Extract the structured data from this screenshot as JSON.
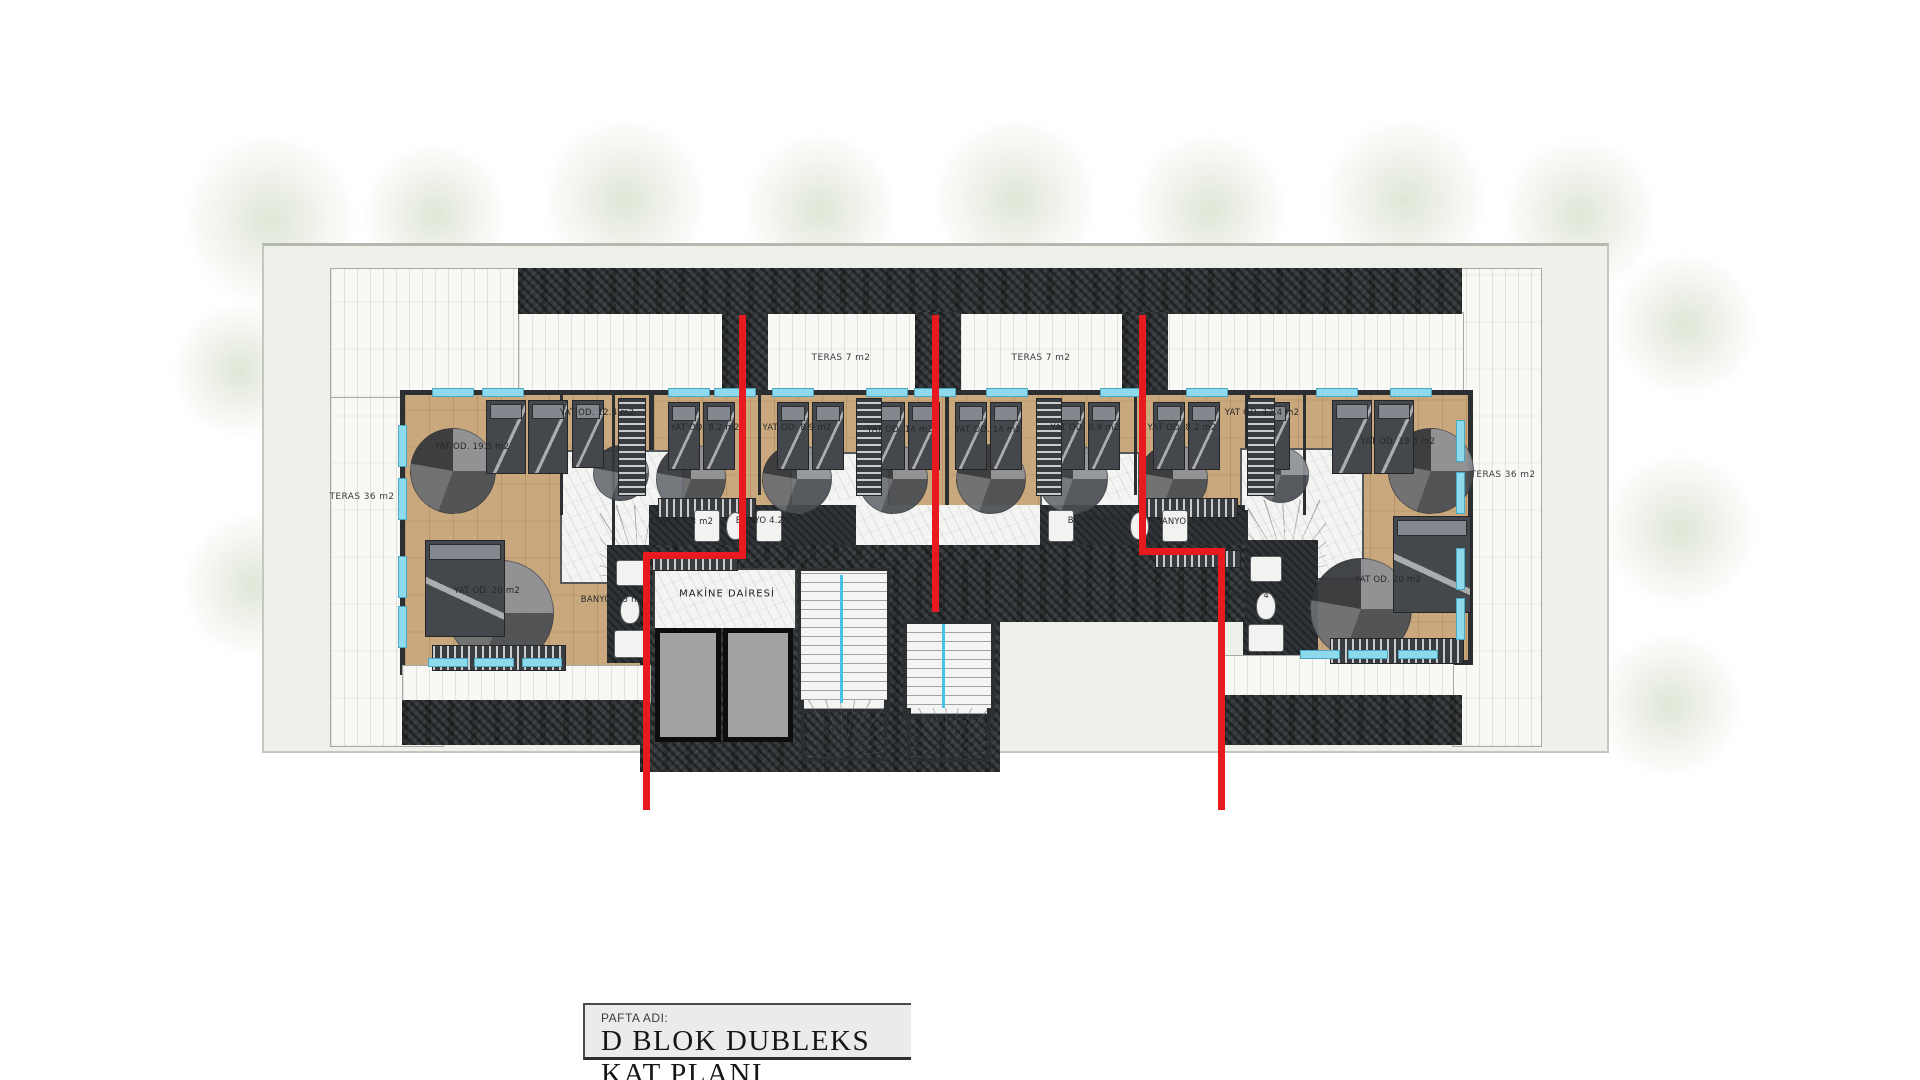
{
  "title_block": {
    "label": "PAFTA ADI:",
    "title": "D BLOK DUBLEKS KAT PLANI"
  },
  "labels": [
    {
      "text": "TERAS 36 m2",
      "x": 362,
      "y": 497,
      "cls": "teras"
    },
    {
      "text": "TERAS 36 m2",
      "x": 1503,
      "y": 475,
      "cls": "teras"
    },
    {
      "text": "TERAS 7 m2",
      "x": 841,
      "y": 358,
      "cls": "teras"
    },
    {
      "text": "TERAS 7 m2",
      "x": 1041,
      "y": 358,
      "cls": "teras"
    },
    {
      "text": "YAT OD. 19.5 m2",
      "x": 472,
      "y": 447,
      "cls": ""
    },
    {
      "text": "YAT OD. 12.4 m2",
      "x": 597,
      "y": 413,
      "cls": ""
    },
    {
      "text": "YAT OD. 8.2 m2",
      "x": 705,
      "y": 428,
      "cls": ""
    },
    {
      "text": "YAT OD. 8.9 m2",
      "x": 797,
      "y": 428,
      "cls": ""
    },
    {
      "text": "YAT OD. 14 m2",
      "x": 900,
      "y": 430,
      "cls": ""
    },
    {
      "text": "YAT OD. 14 m2",
      "x": 988,
      "y": 430,
      "cls": ""
    },
    {
      "text": "YAT OD. 8.9 m2",
      "x": 1085,
      "y": 428,
      "cls": ""
    },
    {
      "text": "YAT OD. 8.2 m2",
      "x": 1182,
      "y": 428,
      "cls": ""
    },
    {
      "text": "YAT OD. 12.4 m2",
      "x": 1262,
      "y": 413,
      "cls": ""
    },
    {
      "text": "YAT OD. 19.5 m2",
      "x": 1398,
      "y": 442,
      "cls": ""
    },
    {
      "text": "YAT OD. 20 m2",
      "x": 487,
      "y": 591,
      "cls": ""
    },
    {
      "text": "YAT OD. 20 m2",
      "x": 1388,
      "y": 580,
      "cls": ""
    },
    {
      "text": "BANYO 4.3 m2",
      "x": 681,
      "y": 522,
      "cls": ""
    },
    {
      "text": "BANYO 4.2 m2",
      "x": 768,
      "y": 521,
      "cls": ""
    },
    {
      "text": "BANYO 4.2 m2",
      "x": 1100,
      "y": 521,
      "cls": ""
    },
    {
      "text": "BANYO 4.3 m2",
      "x": 1188,
      "y": 522,
      "cls": ""
    },
    {
      "text": "BANYO 3.5 m2",
      "x": 613,
      "y": 600,
      "cls": ""
    },
    {
      "text": "BANYO 4 m2",
      "x": 1258,
      "y": 596,
      "cls": ""
    },
    {
      "text": "MAKİNE DAİRESİ",
      "x": 727,
      "y": 594,
      "cls": "big"
    }
  ],
  "plan": {
    "beds_vertical": [
      {
        "x": 486,
        "y": 400,
        "w": 38,
        "h": 72
      },
      {
        "x": 528,
        "y": 400,
        "w": 38,
        "h": 72
      },
      {
        "x": 572,
        "y": 400,
        "w": 30,
        "h": 66
      },
      {
        "x": 668,
        "y": 402,
        "w": 30,
        "h": 66
      },
      {
        "x": 703,
        "y": 402,
        "w": 30,
        "h": 66
      },
      {
        "x": 777,
        "y": 402,
        "w": 30,
        "h": 66
      },
      {
        "x": 812,
        "y": 402,
        "w": 30,
        "h": 66
      },
      {
        "x": 873,
        "y": 402,
        "w": 30,
        "h": 66
      },
      {
        "x": 908,
        "y": 402,
        "w": 30,
        "h": 66
      },
      {
        "x": 955,
        "y": 402,
        "w": 30,
        "h": 66
      },
      {
        "x": 990,
        "y": 402,
        "w": 30,
        "h": 66
      },
      {
        "x": 1053,
        "y": 402,
        "w": 30,
        "h": 66
      },
      {
        "x": 1088,
        "y": 402,
        "w": 30,
        "h": 66
      },
      {
        "x": 1153,
        "y": 402,
        "w": 30,
        "h": 66
      },
      {
        "x": 1188,
        "y": 402,
        "w": 30,
        "h": 66
      },
      {
        "x": 1258,
        "y": 402,
        "w": 30,
        "h": 66
      },
      {
        "x": 1332,
        "y": 400,
        "w": 38,
        "h": 72
      },
      {
        "x": 1374,
        "y": 400,
        "w": 38,
        "h": 72
      },
      {
        "x": 425,
        "y": 540,
        "w": 78,
        "h": 95
      },
      {
        "x": 1393,
        "y": 516,
        "w": 76,
        "h": 95
      }
    ],
    "rugs": [
      {
        "cx": 452,
        "cy": 470,
        "r": 42
      },
      {
        "cx": 620,
        "cy": 472,
        "r": 27
      },
      {
        "cx": 690,
        "cy": 478,
        "r": 34
      },
      {
        "cx": 796,
        "cy": 478,
        "r": 34
      },
      {
        "cx": 892,
        "cy": 478,
        "r": 34
      },
      {
        "cx": 990,
        "cy": 478,
        "r": 34
      },
      {
        "cx": 1072,
        "cy": 478,
        "r": 34
      },
      {
        "cx": 1172,
        "cy": 478,
        "r": 34
      },
      {
        "cx": 1280,
        "cy": 474,
        "r": 27
      },
      {
        "cx": 1430,
        "cy": 470,
        "r": 42
      },
      {
        "cx": 500,
        "cy": 612,
        "r": 52
      },
      {
        "cx": 1360,
        "cy": 608,
        "r": 50
      }
    ],
    "wardrobes_h": [
      {
        "x": 432,
        "y": 645,
        "w": 132,
        "h": 24
      },
      {
        "x": 1330,
        "y": 638,
        "w": 132,
        "h": 24
      },
      {
        "x": 658,
        "y": 498,
        "w": 96,
        "h": 18
      },
      {
        "x": 1140,
        "y": 498,
        "w": 96,
        "h": 18
      },
      {
        "x": 652,
        "y": 553,
        "w": 84,
        "h": 16
      },
      {
        "x": 1155,
        "y": 550,
        "w": 84,
        "h": 16
      }
    ],
    "wardrobes_v": [
      {
        "x": 618,
        "y": 398,
        "w": 26,
        "h": 96
      },
      {
        "x": 1247,
        "y": 398,
        "w": 26,
        "h": 96
      },
      {
        "x": 856,
        "y": 398,
        "w": 24,
        "h": 96
      },
      {
        "x": 1036,
        "y": 398,
        "w": 24,
        "h": 96
      }
    ],
    "windows_top": [
      {
        "x": 432,
        "w": 40
      },
      {
        "x": 482,
        "w": 40
      },
      {
        "x": 668,
        "w": 40
      },
      {
        "x": 714,
        "w": 40
      },
      {
        "x": 772,
        "w": 40
      },
      {
        "x": 866,
        "w": 40
      },
      {
        "x": 914,
        "w": 40
      },
      {
        "x": 986,
        "w": 40
      },
      {
        "x": 1100,
        "w": 40
      },
      {
        "x": 1186,
        "w": 40
      },
      {
        "x": 1316,
        "w": 40
      },
      {
        "x": 1390,
        "w": 40
      }
    ],
    "windows_left": [
      {
        "y": 425,
        "h": 40
      },
      {
        "y": 478,
        "h": 40
      },
      {
        "y": 556,
        "h": 40
      },
      {
        "y": 606,
        "h": 40
      }
    ],
    "windows_right": [
      {
        "y": 420,
        "h": 40
      },
      {
        "y": 472,
        "h": 40
      },
      {
        "y": 548,
        "h": 40
      },
      {
        "y": 598,
        "h": 40
      }
    ],
    "windows_bottom_left": [
      {
        "x": 428,
        "w": 38
      },
      {
        "x": 474,
        "w": 38
      },
      {
        "x": 522,
        "w": 38
      }
    ],
    "windows_bottom_right": [
      {
        "x": 1300,
        "w": 38
      },
      {
        "x": 1348,
        "w": 38
      },
      {
        "x": 1398,
        "w": 38
      }
    ],
    "fixtures": [
      {
        "x": 694,
        "y": 510,
        "w": 24,
        "h": 30,
        "round": false
      },
      {
        "x": 726,
        "y": 512,
        "w": 17,
        "h": 26,
        "round": true
      },
      {
        "x": 756,
        "y": 510,
        "w": 24,
        "h": 30,
        "round": false
      },
      {
        "x": 1048,
        "y": 510,
        "w": 24,
        "h": 30,
        "round": false
      },
      {
        "x": 1130,
        "y": 512,
        "w": 17,
        "h": 26,
        "round": true
      },
      {
        "x": 1162,
        "y": 510,
        "w": 24,
        "h": 30,
        "round": false
      },
      {
        "x": 616,
        "y": 560,
        "w": 30,
        "h": 24,
        "round": false
      },
      {
        "x": 620,
        "y": 596,
        "w": 18,
        "h": 26,
        "round": true
      },
      {
        "x": 614,
        "y": 630,
        "w": 34,
        "h": 26,
        "round": false
      },
      {
        "x": 1250,
        "y": 556,
        "w": 30,
        "h": 24,
        "round": false
      },
      {
        "x": 1256,
        "y": 592,
        "w": 18,
        "h": 26,
        "round": true
      },
      {
        "x": 1248,
        "y": 624,
        "w": 34,
        "h": 26,
        "round": false
      }
    ],
    "trees": [
      {
        "x": 180,
        "y": 130,
        "s": 180
      },
      {
        "x": 360,
        "y": 140,
        "s": 150
      },
      {
        "x": 540,
        "y": 115,
        "s": 170
      },
      {
        "x": 740,
        "y": 130,
        "s": 160
      },
      {
        "x": 930,
        "y": 115,
        "s": 170
      },
      {
        "x": 1130,
        "y": 130,
        "s": 160
      },
      {
        "x": 1320,
        "y": 115,
        "s": 170
      },
      {
        "x": 1500,
        "y": 135,
        "s": 160
      },
      {
        "x": 1610,
        "y": 250,
        "s": 150
      },
      {
        "x": 1600,
        "y": 450,
        "s": 160
      },
      {
        "x": 1595,
        "y": 630,
        "s": 150
      },
      {
        "x": 170,
        "y": 300,
        "s": 140
      },
      {
        "x": 180,
        "y": 510,
        "s": 150
      }
    ],
    "accent_red": "#e8191f",
    "accent_cyan": "#8fd9ec"
  }
}
